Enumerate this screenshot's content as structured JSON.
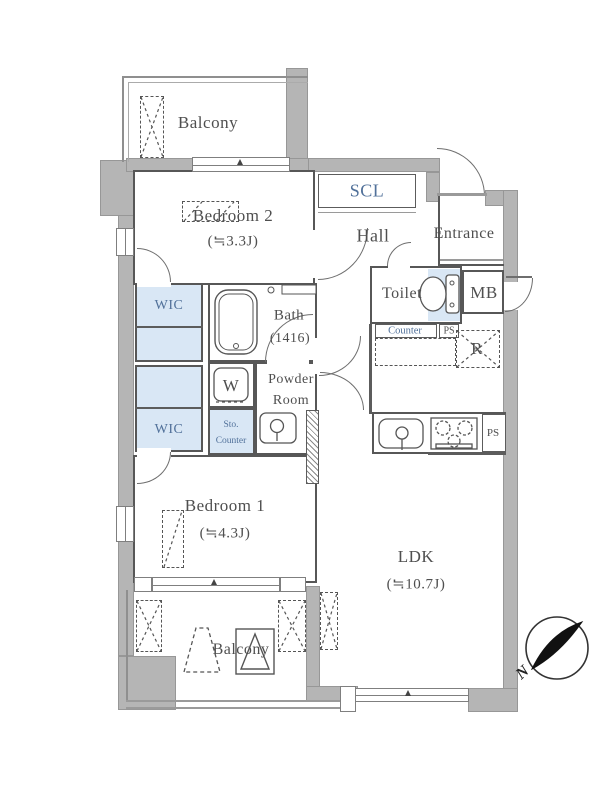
{
  "plan": {
    "rooms": {
      "balcony_top": {
        "label": "Balcony"
      },
      "bedroom2": {
        "label": "Bedroom 2",
        "size": "(≒3.3J)"
      },
      "scl": {
        "label": "SCL"
      },
      "hall": {
        "label": "Hall"
      },
      "entrance": {
        "label": "Entrance"
      },
      "toilet": {
        "label": "Toilet"
      },
      "mb": {
        "label": "MB"
      },
      "counter": {
        "label": "Counter"
      },
      "ps_toilet": {
        "label": "PS"
      },
      "refrigerator": {
        "label": "R"
      },
      "wic_upper": {
        "label": "WIC"
      },
      "wic_lower": {
        "label": "WIC"
      },
      "bath": {
        "label": "Bath",
        "size": "(1416)"
      },
      "washer": {
        "label": "W"
      },
      "powder_room": {
        "label_line1": "Powder",
        "label_line2": "Room"
      },
      "sto_counter": {
        "label_line1": "Sto.",
        "label_line2": "Counter"
      },
      "bedroom1": {
        "label": "Bedroom 1",
        "size": "(≒4.3J)"
      },
      "ldk": {
        "label": "LDK",
        "size": "(≒10.7J)"
      },
      "balcony_bottom": {
        "label": "Balcony"
      },
      "ps_kitchen": {
        "label": "PS"
      }
    },
    "compass": {
      "north_label": "N"
    },
    "colors": {
      "wall_fill": "#b5b5b5",
      "closet_blue": "#d9e7f5",
      "wall_line": "#575757",
      "blue_label_text": "#51719a"
    }
  }
}
